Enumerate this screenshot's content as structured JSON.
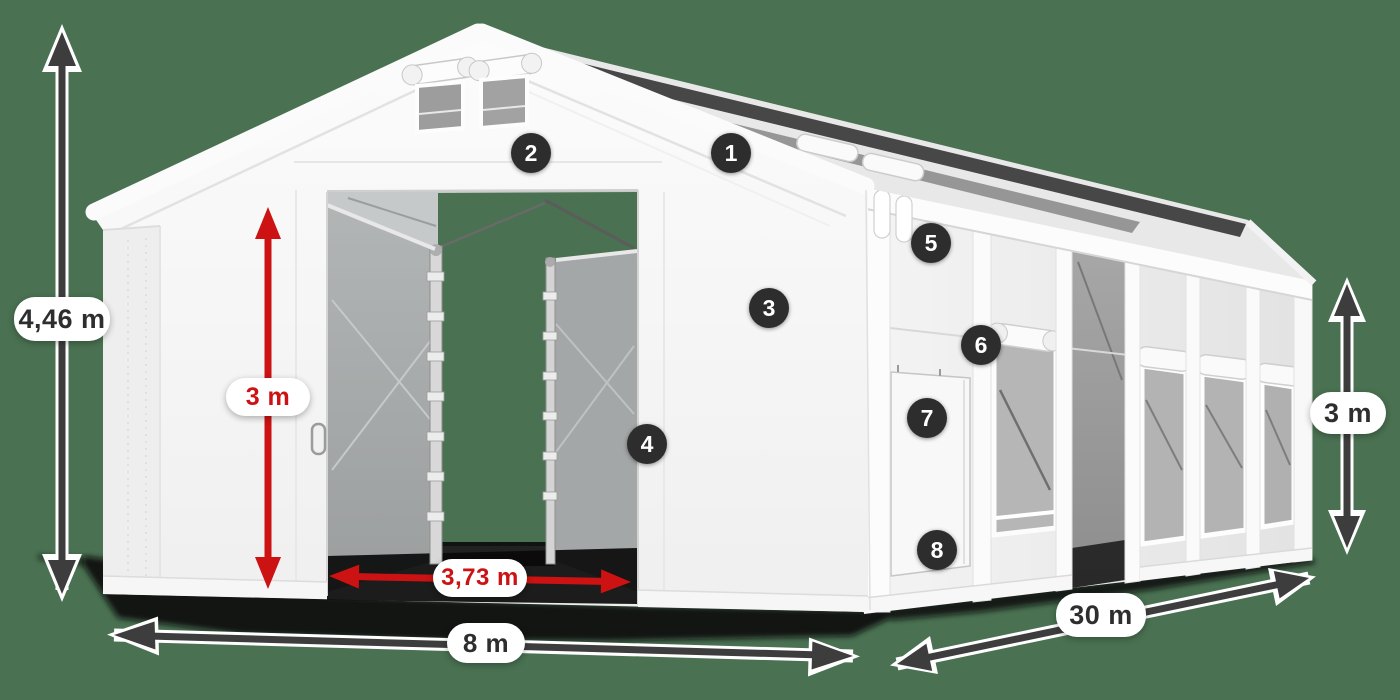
{
  "colors": {
    "background": "#4A7152",
    "tent_white": "#F7F7F7",
    "arrow_dark": "#3D3D3D",
    "arrow_red": "#CC1212",
    "badge_bg": "#2D2D2D",
    "badge_text": "#FFFFFF",
    "label_dark": "#2E2E2E"
  },
  "dimensions": {
    "total_height": {
      "label": "4,46 m",
      "style": "dark"
    },
    "door_height": {
      "label": "3 m",
      "style": "red"
    },
    "door_width": {
      "label": "3,73 m",
      "style": "red"
    },
    "front_width": {
      "label": "8 m",
      "style": "dark"
    },
    "side_length": {
      "label": "30 m",
      "style": "dark"
    },
    "side_height": {
      "label": "3 m",
      "style": "dark"
    }
  },
  "markers": [
    {
      "number": "1"
    },
    {
      "number": "2"
    },
    {
      "number": "3"
    },
    {
      "number": "4"
    },
    {
      "number": "5"
    },
    {
      "number": "6"
    },
    {
      "number": "7"
    },
    {
      "number": "8"
    }
  ]
}
